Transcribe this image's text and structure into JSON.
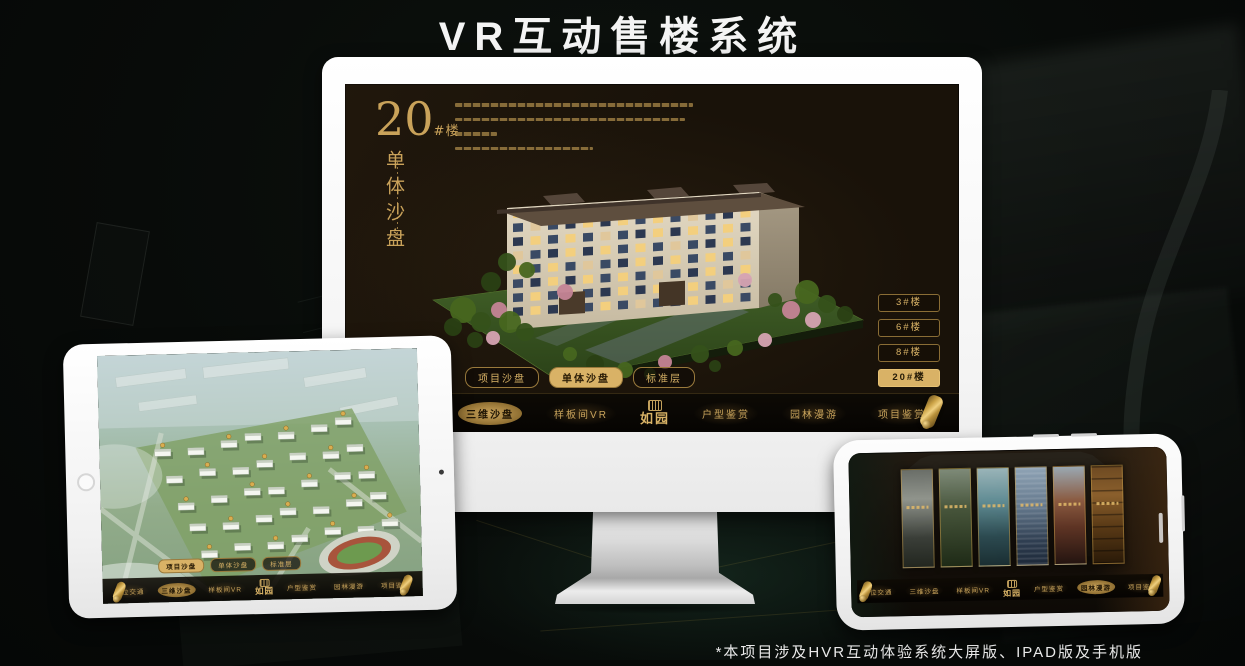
{
  "title": "VR互动售楼系统",
  "footnote": "*本项目涉及HVR互动体验系统大屏版、IPAD版及手机版",
  "brand_logo": "如园",
  "nav_items": [
    "区位交通",
    "三维沙盘",
    "样板间VR",
    "户型鉴赏",
    "园林漫游",
    "项目鉴赏"
  ],
  "sub_tabs": [
    "项目沙盘",
    "单体沙盘",
    "标准层"
  ],
  "monitor": {
    "unit_number": "20",
    "unit_suffix": "#楼",
    "unit_caption": "单体沙盘",
    "floor_buttons": [
      "3#楼",
      "6#楼",
      "8#楼",
      "20#楼"
    ],
    "active_floor": "20#楼",
    "active_sub_tab": "单体沙盘",
    "active_nav": "三维沙盘"
  },
  "tablet": {
    "active_sub_tab": "项目沙盘",
    "active_nav": "三维沙盘"
  },
  "phone": {
    "active_nav": "园林漫游"
  },
  "colors": {
    "gold": "#c9a45c",
    "gold_active_bg": "#d9b266",
    "monitor_screen_bg": "#191209",
    "stadium_track_red": "#a8543c",
    "title_white": "#f4f4f4"
  }
}
